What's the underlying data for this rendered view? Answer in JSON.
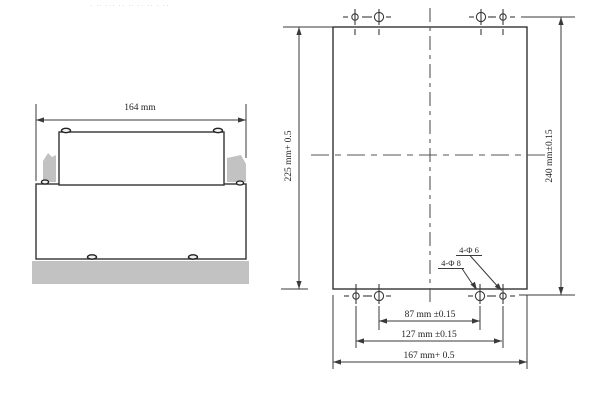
{
  "drawing": {
    "artifact_marks": "· ·· ··· ·· ·· ·· ·· · ··",
    "side_view": {
      "width_dim_label": "164 mm"
    },
    "cutout_view": {
      "height_dim_label": "225 mm+ 0.5",
      "hole_row_span_label": "240 mm±0.15",
      "inner_hole_span_label": "87 mm ±0.15",
      "outer_hole_span_label": "127 mm ±0.15",
      "width_dim_label": "167 mm+ 0.5",
      "callout_small_holes": "4-Φ 6",
      "callout_large_holes": "4-Φ 8"
    },
    "colors": {
      "line": "#3a3a3a",
      "centerline": "#555555",
      "gray_fill": "#c2c2c2",
      "text": "#1f1f1f",
      "background": "#ffffff"
    }
  }
}
